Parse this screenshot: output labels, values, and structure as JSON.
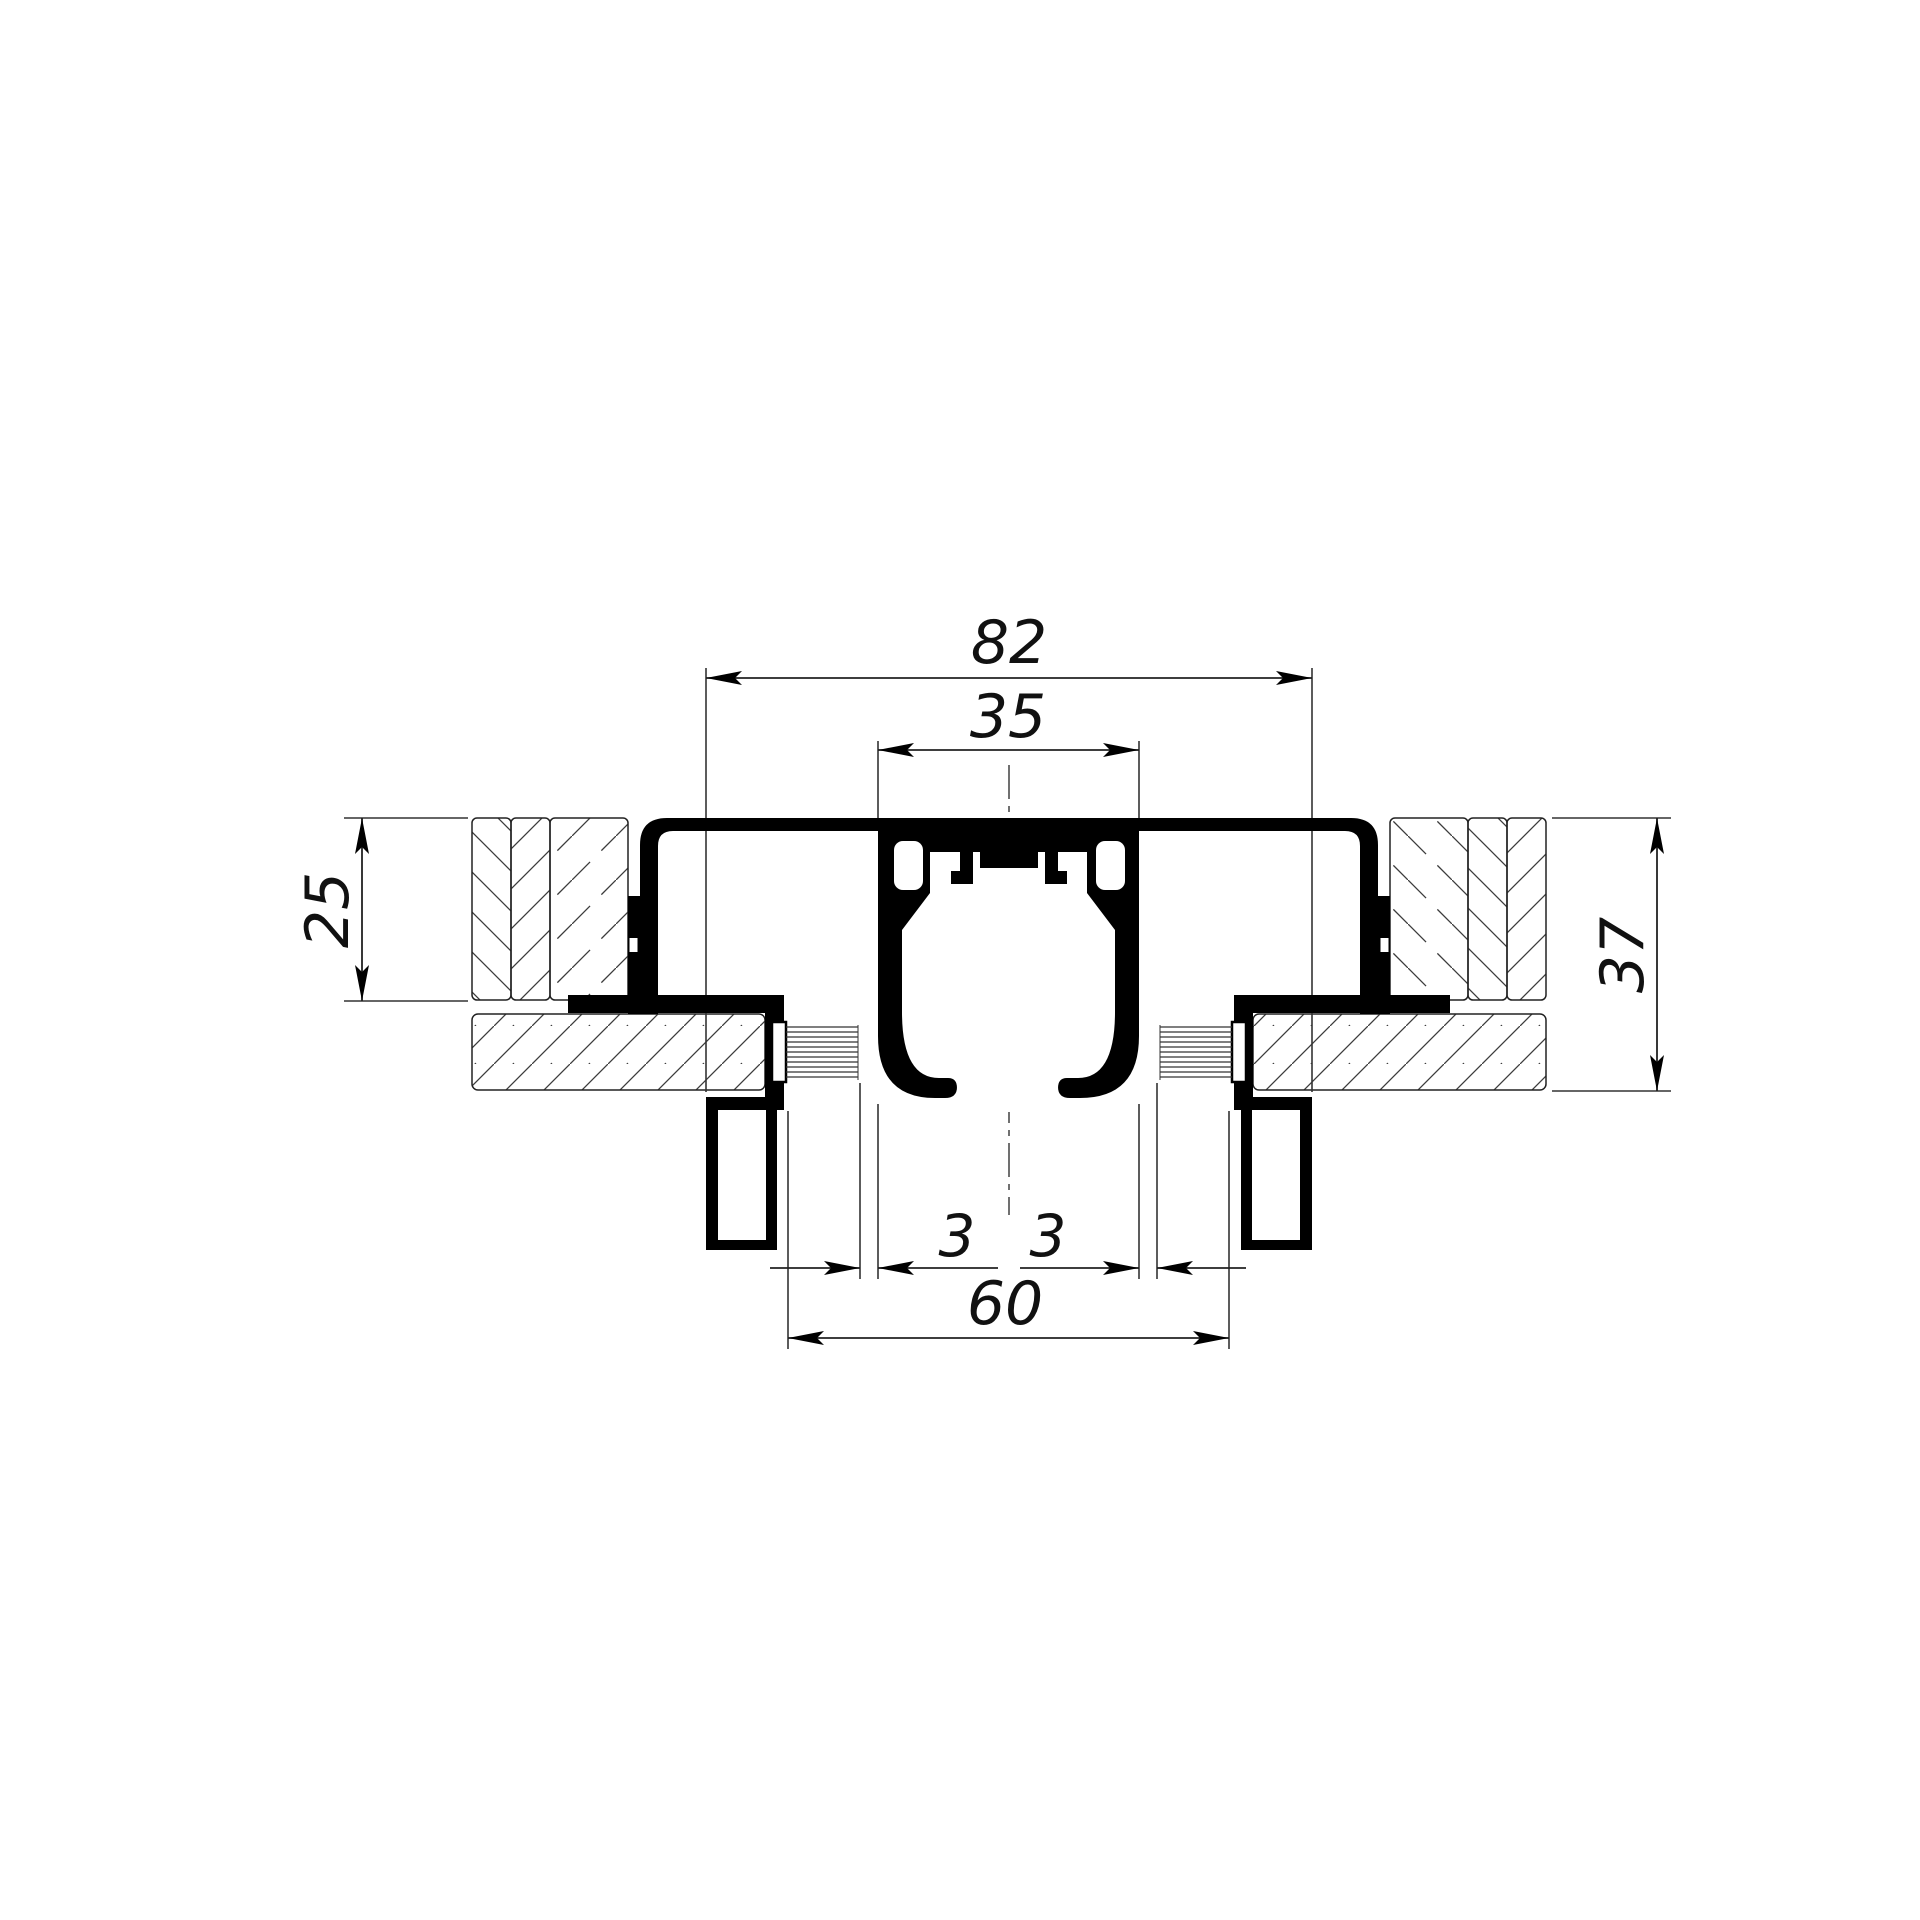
{
  "drawing": {
    "kind": "sliding-door-top-track-cross-section",
    "background_color": "#ffffff",
    "line_color": "#000000",
    "dimensions": {
      "overall_width": {
        "label": "82",
        "value": 82
      },
      "track_width": {
        "label": "35",
        "value": 35
      },
      "cover_height": {
        "label": "25",
        "value": 25
      },
      "frame_depth": {
        "label": "37",
        "value": 37
      },
      "gap_left": {
        "label": "3",
        "value": 3
      },
      "gap_right": {
        "label": "3",
        "value": 3
      },
      "clear_opening": {
        "label": "60",
        "value": 60
      }
    }
  }
}
